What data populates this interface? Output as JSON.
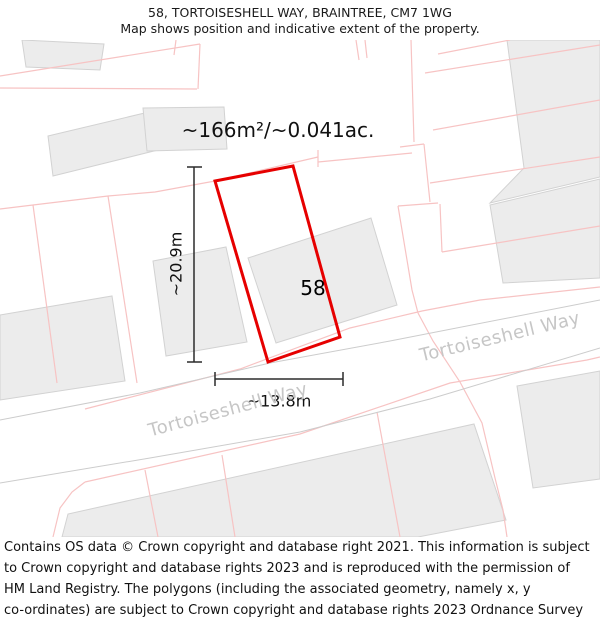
{
  "header": {
    "title": "58, TORTOISESHELL WAY, BRAINTREE, CM7 1WG",
    "subtitle": "Map shows position and indicative extent of the property."
  },
  "map": {
    "area_label": "~166m²/~0.041ac.",
    "property_number": "58",
    "width_label": "~13.8m",
    "height_label": "~20.9m",
    "street_label_1": "Tortoiseshell Way",
    "street_label_2": "Tortoiseshell Way",
    "colors": {
      "property_outline": "#e60000",
      "parcel_line": "#f7c3c3",
      "building_fill": "#ececec",
      "building_stroke": "#d2d2d2",
      "road_edge": "#cccccc",
      "street_text": "#c6c6c6",
      "measure": "#2b2b2b"
    },
    "red_polygon": [
      [
        215,
        181
      ],
      [
        293,
        166
      ],
      [
        340,
        337
      ],
      [
        268,
        362
      ]
    ],
    "buildings": [
      [
        [
          22,
          40
        ],
        [
          104,
          44
        ],
        [
          100,
          70
        ],
        [
          26,
          67
        ]
      ],
      [
        [
          48,
          136
        ],
        [
          153,
          111
        ],
        [
          158,
          150
        ],
        [
          53,
          176
        ]
      ],
      [
        [
          143,
          108
        ],
        [
          224,
          107
        ],
        [
          227,
          149
        ],
        [
          147,
          151
        ]
      ],
      [
        [
          0,
          315
        ],
        [
          112,
          296
        ],
        [
          125,
          381
        ],
        [
          0,
          400
        ]
      ],
      [
        [
          153,
          261
        ],
        [
          226,
          247
        ],
        [
          247,
          342
        ],
        [
          166,
          356
        ]
      ],
      [
        [
          248,
          258
        ],
        [
          371,
          218
        ],
        [
          397,
          305
        ],
        [
          276,
          343
        ]
      ],
      [
        [
          507,
          40
        ],
        [
          600,
          40
        ],
        [
          600,
          177
        ],
        [
          490,
          203
        ],
        [
          524,
          168
        ]
      ],
      [
        [
          490,
          205
        ],
        [
          600,
          179
        ],
        [
          600,
          278
        ],
        [
          503,
          283
        ]
      ],
      [
        [
          62,
          537
        ],
        [
          68,
          514
        ],
        [
          474,
          424
        ],
        [
          506,
          520
        ],
        [
          418,
          537
        ]
      ],
      [
        [
          517,
          386
        ],
        [
          600,
          371
        ],
        [
          600,
          479
        ],
        [
          533,
          488
        ]
      ]
    ],
    "road_lines": [
      [
        [
          0,
          420
        ],
        [
          140,
          393
        ],
        [
          270,
          363
        ],
        [
          390,
          341
        ],
        [
          600,
          300
        ]
      ],
      [
        [
          0,
          483
        ],
        [
          150,
          458
        ],
        [
          300,
          432
        ],
        [
          430,
          399
        ],
        [
          600,
          348
        ]
      ]
    ],
    "parcel_lines": [
      [
        [
          0,
          76
        ],
        [
          200,
          44
        ]
      ],
      [
        [
          0,
          88
        ],
        [
          197,
          89
        ]
      ],
      [
        [
          200,
          44
        ],
        [
          198,
          89
        ]
      ],
      [
        [
          176,
          40
        ],
        [
          174,
          55
        ]
      ],
      [
        [
          356,
          40
        ],
        [
          359,
          60
        ]
      ],
      [
        [
          365,
          40
        ],
        [
          367,
          58
        ]
      ],
      [
        [
          438,
          54
        ],
        [
          510,
          40
        ]
      ],
      [
        [
          0,
          209
        ],
        [
          33,
          205
        ],
        [
          108,
          196
        ],
        [
          155,
          192
        ],
        [
          215,
          181
        ],
        [
          318,
          157
        ]
      ],
      [
        [
          318,
          150
        ],
        [
          318,
          167
        ]
      ],
      [
        [
          318,
          162
        ],
        [
          412,
          153
        ]
      ],
      [
        [
          33,
          205
        ],
        [
          57,
          383
        ]
      ],
      [
        [
          108,
          196
        ],
        [
          137,
          383
        ]
      ],
      [
        [
          411,
          40
        ],
        [
          414,
          142
        ]
      ],
      [
        [
          400,
          147
        ],
        [
          424,
          144
        ]
      ],
      [
        [
          424,
          144
        ],
        [
          428,
          183
        ],
        [
          430,
          202
        ]
      ],
      [
        [
          398,
          206
        ],
        [
          438,
          203
        ]
      ],
      [
        [
          398,
          206
        ],
        [
          412,
          290
        ],
        [
          418,
          313
        ]
      ],
      [
        [
          440,
          204
        ],
        [
          442,
          252
        ]
      ],
      [
        [
          425,
          73
        ],
        [
          600,
          45
        ]
      ],
      [
        [
          433,
          130
        ],
        [
          600,
          100
        ]
      ],
      [
        [
          430,
          183
        ],
        [
          600,
          157
        ]
      ],
      [
        [
          442,
          252
        ],
        [
          600,
          226
        ]
      ],
      [
        [
          85,
          409
        ],
        [
          240,
          369
        ],
        [
          350,
          328
        ],
        [
          422,
          311
        ],
        [
          480,
          300
        ],
        [
          600,
          287
        ]
      ],
      [
        [
          418,
          313
        ],
        [
          433,
          341
        ],
        [
          460,
          382
        ],
        [
          482,
          423
        ],
        [
          495,
          478
        ],
        [
          503,
          510
        ],
        [
          507,
          537
        ]
      ],
      [
        [
          85,
          482
        ],
        [
          300,
          434
        ],
        [
          450,
          383
        ],
        [
          587,
          360
        ],
        [
          600,
          357
        ]
      ],
      [
        [
          53,
          537
        ],
        [
          60,
          508
        ],
        [
          72,
          492
        ],
        [
          85,
          482
        ]
      ],
      [
        [
          377,
          412
        ],
        [
          400,
          537
        ]
      ],
      [
        [
          145,
          470
        ],
        [
          158,
          537
        ]
      ],
      [
        [
          222,
          455
        ],
        [
          235,
          537
        ]
      ]
    ],
    "measure_lines": [
      [
        [
          194,
          167
        ],
        [
          194,
          362
        ]
      ],
      [
        [
          187,
          167
        ],
        [
          202,
          167
        ]
      ],
      [
        [
          187,
          362
        ],
        [
          202,
          362
        ]
      ],
      [
        [
          215,
          379
        ],
        [
          343,
          379
        ]
      ],
      [
        [
          215,
          372
        ],
        [
          215,
          386
        ]
      ],
      [
        [
          343,
          372
        ],
        [
          343,
          386
        ]
      ]
    ]
  },
  "footer": {
    "lines": [
      "Contains OS data © Crown copyright and database right 2021. This information is subject",
      "to Crown copyright and database rights 2023 and is reproduced with the permission of",
      "HM Land Registry. The polygons (including the associated geometry, namely x, y",
      "co-ordinates) are subject to Crown copyright and database rights 2023 Ordnance Survey",
      "100026316."
    ]
  }
}
